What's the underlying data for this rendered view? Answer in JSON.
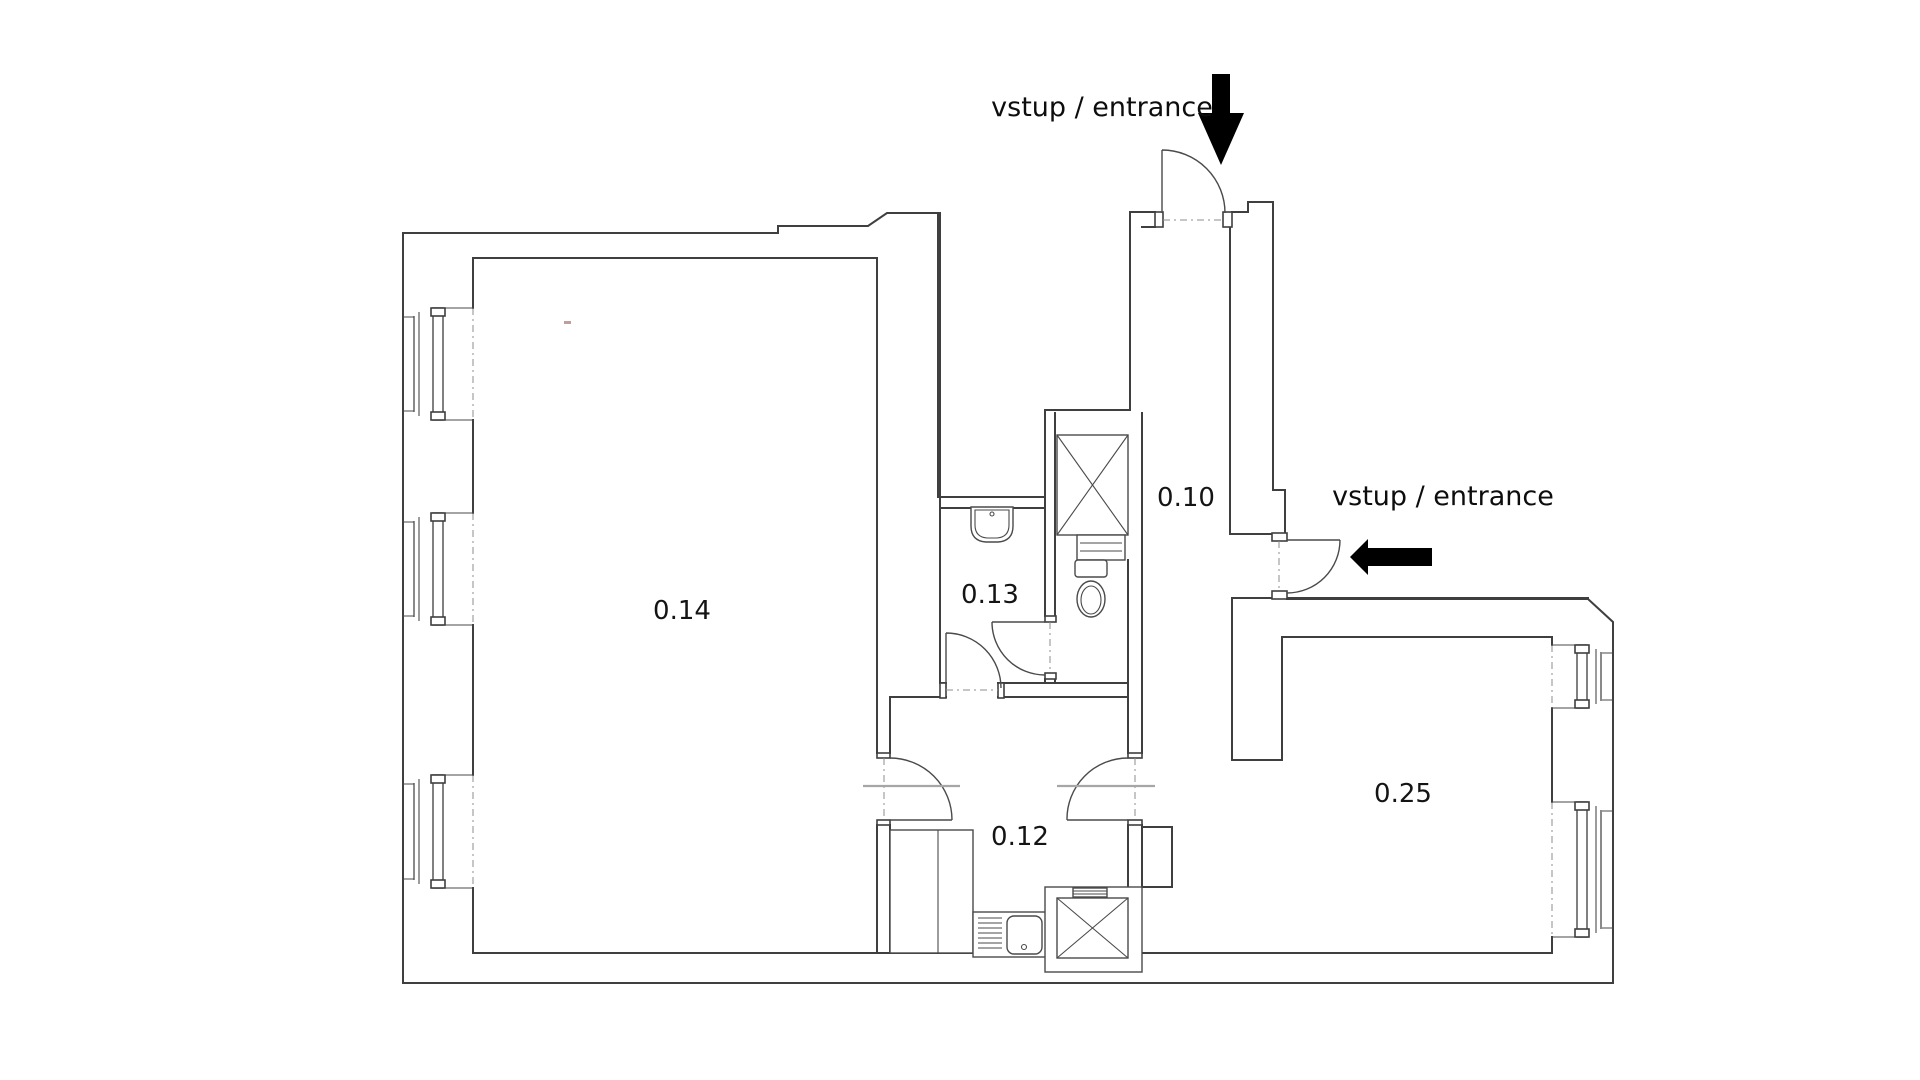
{
  "rooms": [
    {
      "id": "room-0-10",
      "label": "0.10"
    },
    {
      "id": "room-0-12",
      "label": "0.12"
    },
    {
      "id": "room-0-13",
      "label": "0.13"
    },
    {
      "id": "room-0-14",
      "label": "0.14"
    },
    {
      "id": "room-0-25",
      "label": "0.25"
    }
  ],
  "entrances": [
    {
      "id": "entrance-top",
      "label": "vstup / entrance",
      "arrow_direction": "down"
    },
    {
      "id": "entrance-right",
      "label": "vstup / entrance",
      "arrow_direction": "left"
    }
  ],
  "windows": {
    "left_wall_count": 3,
    "right_wall_count": 2
  },
  "doors_count": 6,
  "fixtures": [
    "shaft-top",
    "shaft-bottom",
    "toilet",
    "washbasin",
    "kitchen-counter",
    "kitchen-sink"
  ],
  "colors": {
    "background": "#ffffff",
    "wall_line": "#3f3f3f",
    "text": "#141414",
    "arrow": "#000000",
    "lintel_gray": "#a6a6a6"
  }
}
